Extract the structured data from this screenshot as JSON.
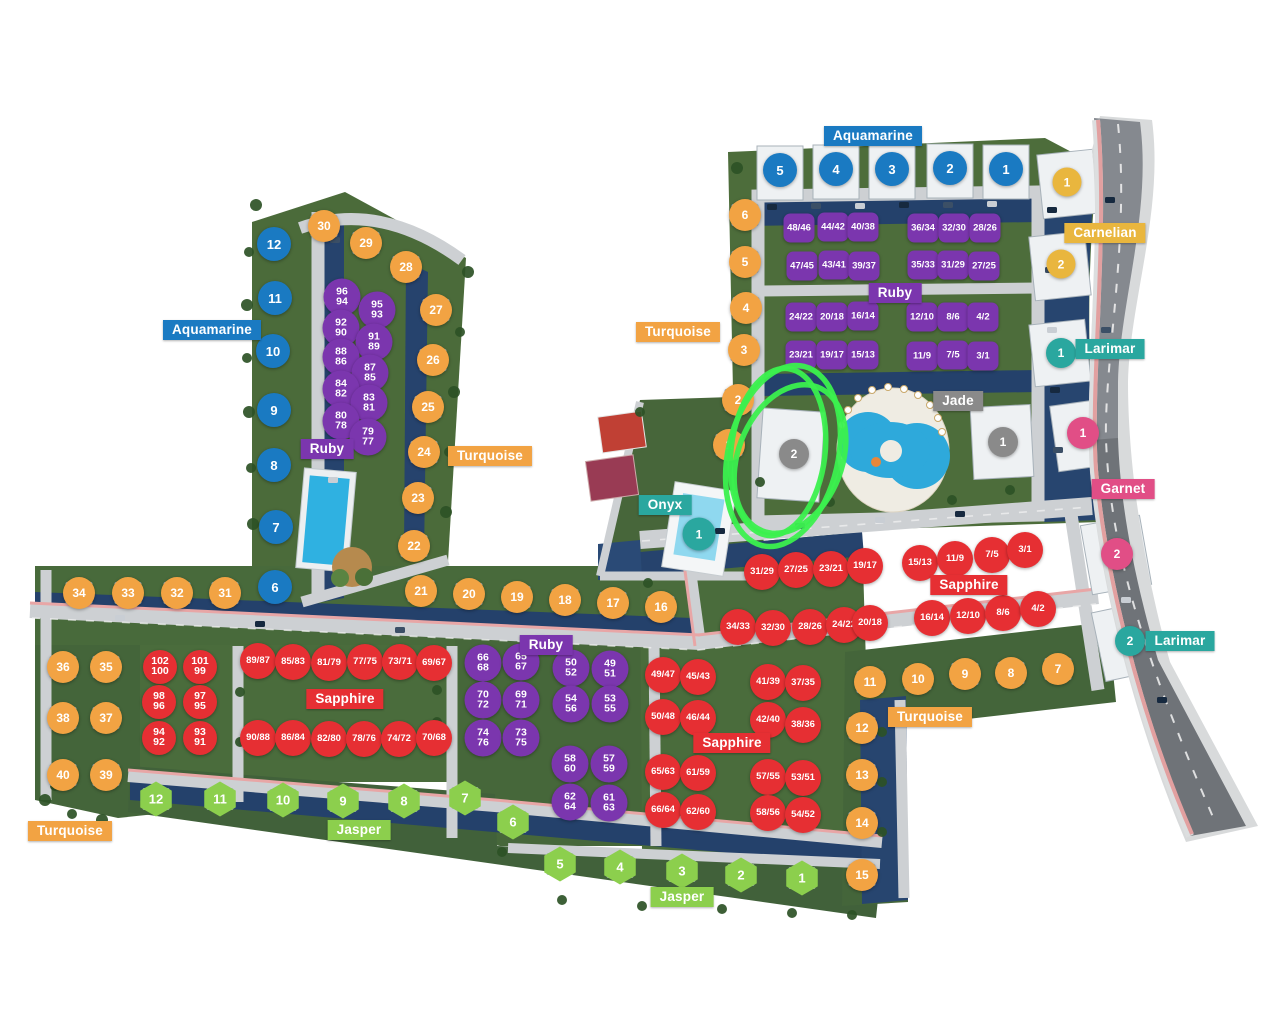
{
  "palette": {
    "blue": "#1a7ac2",
    "orange": "#f2a343",
    "gold": "#e9b63e",
    "purple": "#7b36ae",
    "red": "#e62f33",
    "green": "#8ccf4d",
    "teal": "#2aa79f",
    "pink": "#e14e86",
    "gray": "#8a8a8a"
  },
  "zone_labels": [
    {
      "text": "Aquamarine",
      "x": 873,
      "y": 136,
      "color": "blue"
    },
    {
      "text": "Aquamarine",
      "x": 212,
      "y": 330,
      "color": "blue"
    },
    {
      "text": "Carnelian",
      "x": 1105,
      "y": 233,
      "color": "gold"
    },
    {
      "text": "Larimar",
      "x": 1110,
      "y": 349,
      "color": "teal"
    },
    {
      "text": "Larimar",
      "x": 1180,
      "y": 641,
      "color": "teal"
    },
    {
      "text": "Ruby",
      "x": 895,
      "y": 293,
      "color": "purple"
    },
    {
      "text": "Ruby",
      "x": 327,
      "y": 449,
      "color": "purple"
    },
    {
      "text": "Ruby",
      "x": 546,
      "y": 645,
      "color": "purple"
    },
    {
      "text": "Turquoise",
      "x": 678,
      "y": 332,
      "color": "orange"
    },
    {
      "text": "Turquoise",
      "x": 490,
      "y": 456,
      "color": "orange"
    },
    {
      "text": "Turquoise",
      "x": 930,
      "y": 717,
      "color": "orange"
    },
    {
      "text": "Turquoise",
      "x": 70,
      "y": 831,
      "color": "orange"
    },
    {
      "text": "Jade",
      "x": 958,
      "y": 401,
      "color": "gray"
    },
    {
      "text": "Onyx",
      "x": 665,
      "y": 505,
      "color": "teal"
    },
    {
      "text": "Garnet",
      "x": 1123,
      "y": 489,
      "color": "pink"
    },
    {
      "text": "Sapphire",
      "x": 969,
      "y": 585,
      "color": "red"
    },
    {
      "text": "Sapphire",
      "x": 345,
      "y": 699,
      "color": "red"
    },
    {
      "text": "Sapphire",
      "x": 732,
      "y": 743,
      "color": "red"
    },
    {
      "text": "Jasper",
      "x": 359,
      "y": 830,
      "color": "green"
    },
    {
      "text": "Jasper",
      "x": 682,
      "y": 897,
      "color": "green"
    }
  ],
  "marker_groups": [
    {
      "name": "aquamarine-building",
      "shape": "circle",
      "color": "blue",
      "size": 34,
      "font": 13,
      "villa": true,
      "items": [
        {
          "t": "5",
          "x": 780,
          "y": 170
        },
        {
          "t": "4",
          "x": 836,
          "y": 169
        },
        {
          "t": "3",
          "x": 892,
          "y": 169
        },
        {
          "t": "2",
          "x": 950,
          "y": 168
        },
        {
          "t": "1",
          "x": 1006,
          "y": 169
        },
        {
          "t": "12",
          "x": 274,
          "y": 244
        },
        {
          "t": "11",
          "x": 275,
          "y": 298
        },
        {
          "t": "10",
          "x": 273,
          "y": 351
        },
        {
          "t": "9",
          "x": 274,
          "y": 410
        },
        {
          "t": "8",
          "x": 274,
          "y": 465
        },
        {
          "t": "7",
          "x": 276,
          "y": 527
        },
        {
          "t": "6",
          "x": 275,
          "y": 587
        }
      ]
    },
    {
      "name": "turquoise-villa",
      "shape": "circle",
      "color": "orange",
      "size": 32,
      "font": 12,
      "villa": true,
      "items": [
        {
          "t": "30",
          "x": 324,
          "y": 226
        },
        {
          "t": "29",
          "x": 366,
          "y": 243
        },
        {
          "t": "28",
          "x": 406,
          "y": 267
        },
        {
          "t": "27",
          "x": 436,
          "y": 310
        },
        {
          "t": "26",
          "x": 433,
          "y": 360
        },
        {
          "t": "25",
          "x": 428,
          "y": 407
        },
        {
          "t": "24",
          "x": 424,
          "y": 452
        },
        {
          "t": "23",
          "x": 418,
          "y": 498
        },
        {
          "t": "22",
          "x": 414,
          "y": 546
        },
        {
          "t": "21",
          "x": 421,
          "y": 591
        },
        {
          "t": "20",
          "x": 469,
          "y": 594
        },
        {
          "t": "19",
          "x": 517,
          "y": 597
        },
        {
          "t": "18",
          "x": 565,
          "y": 600
        },
        {
          "t": "17",
          "x": 613,
          "y": 603
        },
        {
          "t": "16",
          "x": 661,
          "y": 607
        },
        {
          "t": "6",
          "x": 745,
          "y": 215
        },
        {
          "t": "5",
          "x": 745,
          "y": 262
        },
        {
          "t": "4",
          "x": 746,
          "y": 308
        },
        {
          "t": "3",
          "x": 744,
          "y": 350
        },
        {
          "t": "2",
          "x": 738,
          "y": 400
        },
        {
          "t": "1",
          "x": 729,
          "y": 445
        },
        {
          "t": "34",
          "x": 79,
          "y": 593
        },
        {
          "t": "33",
          "x": 128,
          "y": 593
        },
        {
          "t": "32",
          "x": 177,
          "y": 593
        },
        {
          "t": "31",
          "x": 225,
          "y": 593
        },
        {
          "t": "36",
          "x": 63,
          "y": 667
        },
        {
          "t": "35",
          "x": 106,
          "y": 667
        },
        {
          "t": "38",
          "x": 63,
          "y": 718
        },
        {
          "t": "37",
          "x": 106,
          "y": 718
        },
        {
          "t": "40",
          "x": 63,
          "y": 775
        },
        {
          "t": "39",
          "x": 106,
          "y": 775
        },
        {
          "t": "11",
          "x": 870,
          "y": 682
        },
        {
          "t": "10",
          "x": 918,
          "y": 679
        },
        {
          "t": "9",
          "x": 965,
          "y": 674
        },
        {
          "t": "8",
          "x": 1011,
          "y": 673
        },
        {
          "t": "7",
          "x": 1058,
          "y": 669
        },
        {
          "t": "12",
          "x": 862,
          "y": 728
        },
        {
          "t": "13",
          "x": 862,
          "y": 775
        },
        {
          "t": "14",
          "x": 862,
          "y": 823
        },
        {
          "t": "15",
          "x": 862,
          "y": 875
        }
      ]
    },
    {
      "name": "carnelian-building",
      "shape": "circle",
      "color": "gold",
      "size": 29,
      "font": 12,
      "villa": false,
      "items": [
        {
          "t": "1",
          "x": 1067,
          "y": 182
        },
        {
          "t": "2",
          "x": 1061,
          "y": 264
        }
      ]
    },
    {
      "name": "ruby-duplex",
      "shape": "square",
      "color": "purple",
      "size": 31,
      "font": 9.5,
      "villa": true,
      "items": [
        {
          "t": "48/46",
          "x": 799,
          "y": 228
        },
        {
          "t": "44/42",
          "x": 833,
          "y": 227
        },
        {
          "t": "40/38",
          "x": 863,
          "y": 227
        },
        {
          "t": "36/34",
          "x": 923,
          "y": 228
        },
        {
          "t": "32/30",
          "x": 954,
          "y": 228
        },
        {
          "t": "28/26",
          "x": 985,
          "y": 228
        },
        {
          "t": "47/45",
          "x": 802,
          "y": 266
        },
        {
          "t": "43/41",
          "x": 834,
          "y": 265
        },
        {
          "t": "39/37",
          "x": 864,
          "y": 266
        },
        {
          "t": "35/33",
          "x": 923,
          "y": 265
        },
        {
          "t": "31/29",
          "x": 953,
          "y": 265
        },
        {
          "t": "27/25",
          "x": 984,
          "y": 266
        },
        {
          "t": "24/22",
          "x": 801,
          "y": 317
        },
        {
          "t": "20/18",
          "x": 832,
          "y": 317
        },
        {
          "t": "16/14",
          "x": 863,
          "y": 316
        },
        {
          "t": "12/10",
          "x": 922,
          "y": 317
        },
        {
          "t": "8/6",
          "x": 953,
          "y": 317
        },
        {
          "t": "4/2",
          "x": 983,
          "y": 317
        },
        {
          "t": "23/21",
          "x": 801,
          "y": 355
        },
        {
          "t": "19/17",
          "x": 832,
          "y": 355
        },
        {
          "t": "15/13",
          "x": 863,
          "y": 355
        },
        {
          "t": "11/9",
          "x": 922,
          "y": 356
        },
        {
          "t": "7/5",
          "x": 953,
          "y": 355
        },
        {
          "t": "3/1",
          "x": 983,
          "y": 356
        }
      ]
    },
    {
      "name": "ruby-villa",
      "shape": "circle",
      "color": "purple",
      "size": 37,
      "font": 10.5,
      "stack": true,
      "villa": true,
      "items": [
        {
          "t": "96/94",
          "x": 342,
          "y": 297
        },
        {
          "t": "95/93",
          "x": 377,
          "y": 310
        },
        {
          "t": "92/90",
          "x": 341,
          "y": 328
        },
        {
          "t": "91/89",
          "x": 374,
          "y": 342
        },
        {
          "t": "88/86",
          "x": 341,
          "y": 357
        },
        {
          "t": "87/85",
          "x": 370,
          "y": 373
        },
        {
          "t": "84/82",
          "x": 341,
          "y": 389
        },
        {
          "t": "83/81",
          "x": 369,
          "y": 403
        },
        {
          "t": "80/78",
          "x": 341,
          "y": 421
        },
        {
          "t": "79/77",
          "x": 368,
          "y": 437
        },
        {
          "t": "66/68",
          "x": 483,
          "y": 663
        },
        {
          "t": "65/67",
          "x": 521,
          "y": 662
        },
        {
          "t": "70/72",
          "x": 483,
          "y": 700
        },
        {
          "t": "69/71",
          "x": 521,
          "y": 700
        },
        {
          "t": "74/76",
          "x": 483,
          "y": 738
        },
        {
          "t": "73/75",
          "x": 521,
          "y": 738
        },
        {
          "t": "50/52",
          "x": 571,
          "y": 668
        },
        {
          "t": "49/51",
          "x": 610,
          "y": 669
        },
        {
          "t": "54/56",
          "x": 571,
          "y": 704
        },
        {
          "t": "53/55",
          "x": 610,
          "y": 704
        },
        {
          "t": "58/60",
          "x": 570,
          "y": 764
        },
        {
          "t": "57/59",
          "x": 609,
          "y": 764
        },
        {
          "t": "62/64",
          "x": 570,
          "y": 802
        },
        {
          "t": "61/63",
          "x": 609,
          "y": 803
        }
      ]
    },
    {
      "name": "sapphire-villa",
      "shape": "circle",
      "color": "red",
      "size": 36,
      "font": 9.5,
      "villa": true,
      "items": [
        {
          "t": "31/29",
          "x": 762,
          "y": 572
        },
        {
          "t": "27/25",
          "x": 796,
          "y": 570
        },
        {
          "t": "23/21",
          "x": 831,
          "y": 569
        },
        {
          "t": "19/17",
          "x": 865,
          "y": 566
        },
        {
          "t": "15/13",
          "x": 920,
          "y": 563
        },
        {
          "t": "11/9",
          "x": 955,
          "y": 559
        },
        {
          "t": "7/5",
          "x": 992,
          "y": 555
        },
        {
          "t": "3/1",
          "x": 1025,
          "y": 550
        },
        {
          "t": "34/33",
          "x": 738,
          "y": 627
        },
        {
          "t": "32/30",
          "x": 773,
          "y": 628
        },
        {
          "t": "28/26",
          "x": 810,
          "y": 627
        },
        {
          "t": "24/22",
          "x": 844,
          "y": 625
        },
        {
          "t": "20/18",
          "x": 870,
          "y": 623
        },
        {
          "t": "16/14",
          "x": 932,
          "y": 618
        },
        {
          "t": "12/10",
          "x": 968,
          "y": 616
        },
        {
          "t": "8/6",
          "x": 1003,
          "y": 613
        },
        {
          "t": "4/2",
          "x": 1038,
          "y": 609
        },
        {
          "t": "89/87",
          "x": 258,
          "y": 661
        },
        {
          "t": "85/83",
          "x": 293,
          "y": 662
        },
        {
          "t": "81/79",
          "x": 329,
          "y": 663
        },
        {
          "t": "77/75",
          "x": 365,
          "y": 662
        },
        {
          "t": "73/71",
          "x": 400,
          "y": 662
        },
        {
          "t": "69/67",
          "x": 434,
          "y": 663
        },
        {
          "t": "90/88",
          "x": 258,
          "y": 738
        },
        {
          "t": "86/84",
          "x": 293,
          "y": 738
        },
        {
          "t": "82/80",
          "x": 329,
          "y": 739
        },
        {
          "t": "78/76",
          "x": 364,
          "y": 739
        },
        {
          "t": "74/72",
          "x": 399,
          "y": 739
        },
        {
          "t": "70/68",
          "x": 434,
          "y": 738
        },
        {
          "t": "49/47",
          "x": 663,
          "y": 675
        },
        {
          "t": "45/43",
          "x": 698,
          "y": 677
        },
        {
          "t": "41/39",
          "x": 768,
          "y": 682
        },
        {
          "t": "37/35",
          "x": 803,
          "y": 683
        },
        {
          "t": "50/48",
          "x": 663,
          "y": 717
        },
        {
          "t": "46/44",
          "x": 698,
          "y": 718
        },
        {
          "t": "42/40",
          "x": 768,
          "y": 720
        },
        {
          "t": "38/36",
          "x": 803,
          "y": 725
        },
        {
          "t": "65/63",
          "x": 663,
          "y": 772
        },
        {
          "t": "61/59",
          "x": 698,
          "y": 773
        },
        {
          "t": "57/55",
          "x": 768,
          "y": 777
        },
        {
          "t": "53/51",
          "x": 803,
          "y": 778
        },
        {
          "t": "66/64",
          "x": 663,
          "y": 810
        },
        {
          "t": "62/60",
          "x": 698,
          "y": 812
        },
        {
          "t": "58/56",
          "x": 768,
          "y": 813
        },
        {
          "t": "54/52",
          "x": 803,
          "y": 815
        }
      ]
    },
    {
      "name": "sapphire-villa-stacked",
      "shape": "circle",
      "color": "red",
      "size": 34,
      "font": 10.5,
      "stack": true,
      "villa": true,
      "items": [
        {
          "t": "102/100",
          "x": 160,
          "y": 667
        },
        {
          "t": "101/99",
          "x": 200,
          "y": 667
        },
        {
          "t": "98/96",
          "x": 159,
          "y": 702
        },
        {
          "t": "97/95",
          "x": 200,
          "y": 702
        },
        {
          "t": "94/92",
          "x": 159,
          "y": 738
        },
        {
          "t": "93/91",
          "x": 200,
          "y": 738
        }
      ]
    },
    {
      "name": "jasper-villa",
      "shape": "hex",
      "color": "green",
      "size": 35,
      "font": 13,
      "villa": true,
      "items": [
        {
          "t": "12",
          "x": 156,
          "y": 799
        },
        {
          "t": "11",
          "x": 220,
          "y": 799
        },
        {
          "t": "10",
          "x": 283,
          "y": 800
        },
        {
          "t": "9",
          "x": 343,
          "y": 801
        },
        {
          "t": "8",
          "x": 404,
          "y": 801
        },
        {
          "t": "7",
          "x": 465,
          "y": 798
        },
        {
          "t": "6",
          "x": 513,
          "y": 822
        },
        {
          "t": "5",
          "x": 560,
          "y": 864
        },
        {
          "t": "4",
          "x": 620,
          "y": 867
        },
        {
          "t": "3",
          "x": 682,
          "y": 871
        },
        {
          "t": "2",
          "x": 741,
          "y": 875
        },
        {
          "t": "1",
          "x": 802,
          "y": 878
        }
      ]
    },
    {
      "name": "onyx-building",
      "shape": "circle",
      "color": "teal",
      "size": 33,
      "font": 12,
      "villa": false,
      "items": [
        {
          "t": "1",
          "x": 699,
          "y": 534
        }
      ]
    },
    {
      "name": "larimar-building",
      "shape": "circle",
      "color": "teal",
      "size": 30,
      "font": 12,
      "villa": false,
      "items": [
        {
          "t": "1",
          "x": 1061,
          "y": 353
        },
        {
          "t": "2",
          "x": 1130,
          "y": 641
        }
      ]
    },
    {
      "name": "garnet-building",
      "shape": "circle",
      "color": "pink",
      "size": 32,
      "font": 12,
      "villa": false,
      "items": [
        {
          "t": "1",
          "x": 1083,
          "y": 433
        },
        {
          "t": "2",
          "x": 1117,
          "y": 554
        }
      ]
    },
    {
      "name": "jade-building",
      "shape": "circle",
      "color": "gray",
      "size": 30,
      "font": 12,
      "villa": false,
      "items": [
        {
          "t": "2",
          "x": 794,
          "y": 454
        },
        {
          "t": "1",
          "x": 1003,
          "y": 442
        }
      ]
    }
  ],
  "annotation": {
    "color": "#3bf04e",
    "stroke": 5.5,
    "loops": [
      {
        "cx": 783,
        "cy": 456,
        "rx": 55,
        "ry": 92,
        "rot": 13
      },
      {
        "cx": 778,
        "cy": 452,
        "rx": 47,
        "ry": 84,
        "rot": 7
      },
      {
        "cx": 790,
        "cy": 459,
        "rx": 52,
        "ry": 77,
        "rot": 21
      }
    ]
  }
}
